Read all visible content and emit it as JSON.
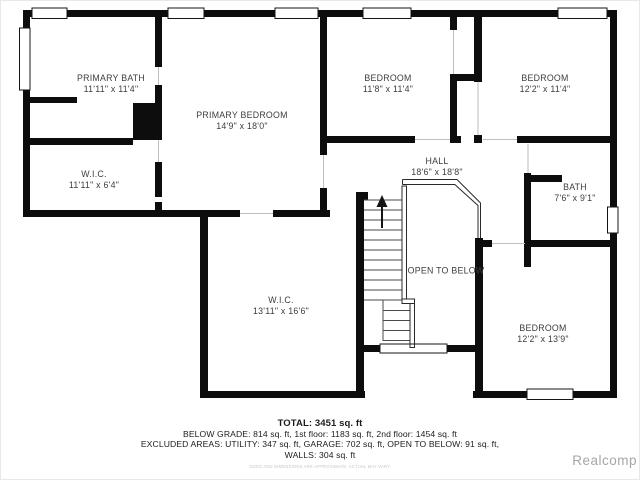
{
  "rooms": [
    {
      "name": "PRIMARY BATH",
      "dims": "11'11\" x 11'4\""
    },
    {
      "name": "W.I.C.",
      "dims": "11'11\" x 6'4\""
    },
    {
      "name": "PRIMARY BEDROOM",
      "dims": "14'9\" x 18'0\""
    },
    {
      "name": "BEDROOM",
      "dims": "11'8\" x 11'4\""
    },
    {
      "name": "BEDROOM",
      "dims": "12'2\" x 11'4\""
    },
    {
      "name": "HALL",
      "dims": "18'6\" x 18'8\""
    },
    {
      "name": "BATH",
      "dims": "7'6\" x 9'1\""
    },
    {
      "name": "OPEN TO BELOW",
      "dims": ""
    },
    {
      "name": "W.I.C.",
      "dims": "13'11\" x 16'6\""
    },
    {
      "name": "BEDROOM",
      "dims": "12'2\" x 13'9\""
    }
  ],
  "summary": {
    "total": "TOTAL: 3451 sq. ft",
    "below_grade": "BELOW GRADE: 814 sq. ft, 1st floor: 1183 sq. ft, 2nd floor: 1454 sq. ft",
    "excluded": "EXCLUDED AREAS: UTILITY: 347 sq. ft, GARAGE: 702 sq. ft, OPEN TO BELOW: 91 sq. ft,",
    "walls": "WALLS: 304 sq. ft"
  },
  "disclaimer": "SIZES AND DIMENSIONS ARE APPROXIMATE, ACTUAL MAY VARY.",
  "watermark": "Realcomp",
  "colors": {
    "wall": "#0d0d0d",
    "room_label": "#3d3d3d",
    "footer_text": "#1c1c1c",
    "watermark": "#a6a6a6"
  }
}
